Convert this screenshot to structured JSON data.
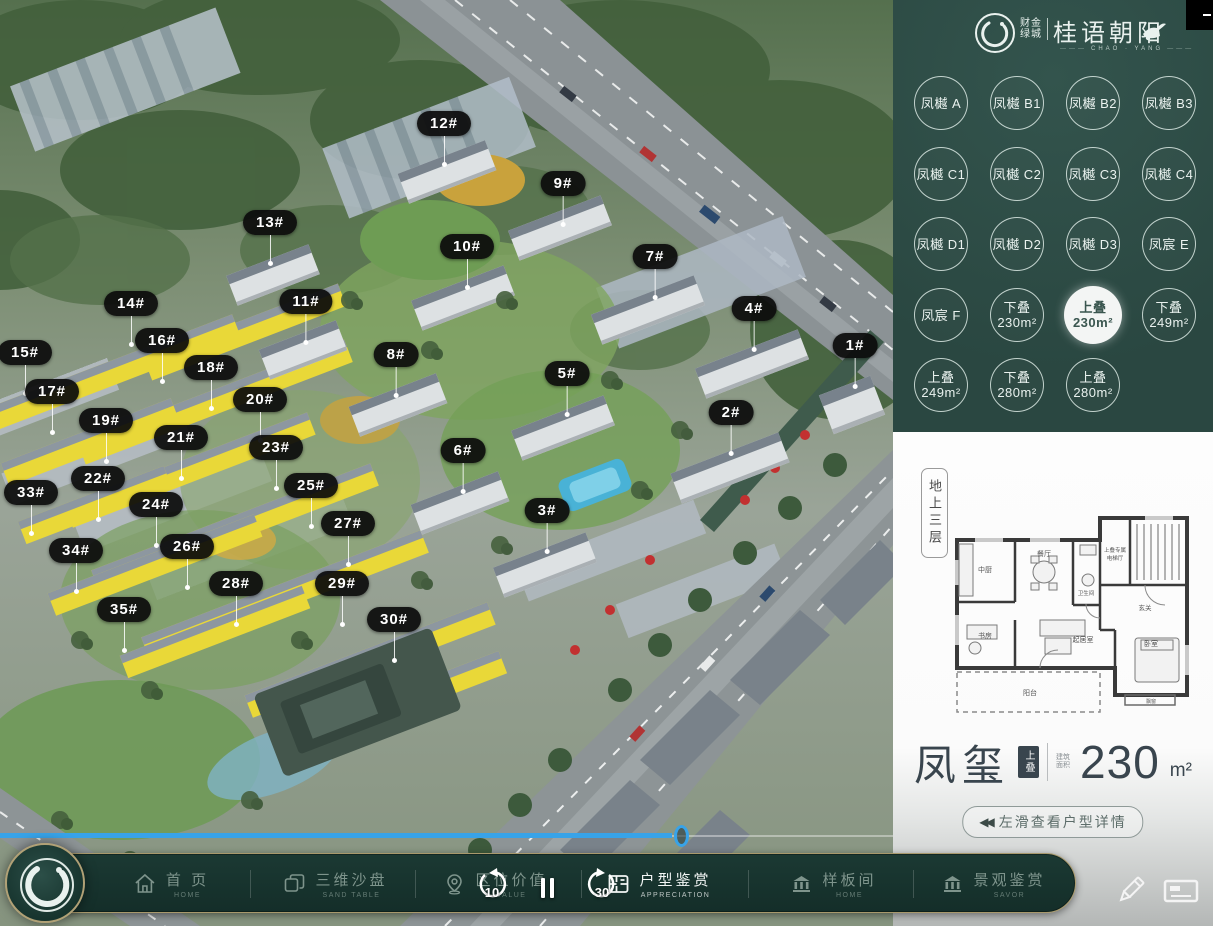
{
  "brand": {
    "pre_line1": "财金",
    "pre_line2": "绿城",
    "name": "桂语朝阳",
    "sub": "CHAO · YANG"
  },
  "unit_selector": {
    "buttons": [
      {
        "label": "凤樾 A"
      },
      {
        "label": "凤樾 B1"
      },
      {
        "label": "凤樾 B2"
      },
      {
        "label": "凤樾 B3"
      },
      {
        "label": "凤樾 C1"
      },
      {
        "label": "凤樾 C2"
      },
      {
        "label": "凤樾 C3"
      },
      {
        "label": "凤樾 C4"
      },
      {
        "label": "凤樾 D1"
      },
      {
        "label": "凤樾 D2"
      },
      {
        "label": "凤樾 D3"
      },
      {
        "label": "凤宸 E"
      },
      {
        "label": "凤宸 F"
      },
      {
        "line1": "下叠",
        "line2": "230m²"
      },
      {
        "line1": "上叠",
        "line2": "230m²",
        "selected": true
      },
      {
        "line1": "下叠",
        "line2": "249m²"
      },
      {
        "line1": "上叠",
        "line2": "249m²"
      },
      {
        "line1": "下叠",
        "line2": "280m²"
      },
      {
        "line1": "上叠",
        "line2": "280m²"
      }
    ]
  },
  "floorplan": {
    "floor_tag": "地上三层",
    "name": "凤玺",
    "name_tag": "上叠",
    "area_prefix": "建筑面积",
    "area": "230",
    "area_unit": "m²",
    "slide_hint": "左滑查看户型详情",
    "slide_icon": "◀◀",
    "rooms": [
      {
        "t": "中厨",
        "x": 40,
        "y": 82,
        "s": 7
      },
      {
        "t": "餐厅",
        "x": 99,
        "y": 66,
        "s": 7
      },
      {
        "t": "卫生间",
        "x": 141,
        "y": 105,
        "s": 5.5
      },
      {
        "t": "上叠专属",
        "x": 170,
        "y": 62,
        "s": 5.5
      },
      {
        "t": "电梯厅",
        "x": 170,
        "y": 70,
        "s": 5.5
      },
      {
        "t": "玄关",
        "x": 200,
        "y": 120,
        "s": 6.5
      },
      {
        "t": "书房",
        "x": 40,
        "y": 148,
        "s": 7
      },
      {
        "t": "起居室",
        "x": 138,
        "y": 152,
        "s": 7
      },
      {
        "t": "卧室",
        "x": 206,
        "y": 156,
        "s": 7
      },
      {
        "t": "阳台",
        "x": 85,
        "y": 205,
        "s": 7
      },
      {
        "t": "飘窗",
        "x": 206,
        "y": 213,
        "s": 5
      }
    ]
  },
  "map": {
    "labels": [
      {
        "text": "1#",
        "x": 855,
        "y": 356
      },
      {
        "text": "2#",
        "x": 731,
        "y": 423
      },
      {
        "text": "3#",
        "x": 547,
        "y": 521
      },
      {
        "text": "4#",
        "x": 754,
        "y": 319
      },
      {
        "text": "5#",
        "x": 567,
        "y": 384
      },
      {
        "text": "6#",
        "x": 463,
        "y": 461
      },
      {
        "text": "7#",
        "x": 655,
        "y": 267
      },
      {
        "text": "8#",
        "x": 396,
        "y": 365
      },
      {
        "text": "9#",
        "x": 563,
        "y": 194
      },
      {
        "text": "10#",
        "x": 467,
        "y": 257
      },
      {
        "text": "11#",
        "x": 306,
        "y": 312
      },
      {
        "text": "12#",
        "x": 444,
        "y": 134
      },
      {
        "text": "13#",
        "x": 270,
        "y": 233
      },
      {
        "text": "14#",
        "x": 131,
        "y": 314
      },
      {
        "text": "15#",
        "x": 25,
        "y": 363
      },
      {
        "text": "16#",
        "x": 162,
        "y": 351
      },
      {
        "text": "17#",
        "x": 52,
        "y": 402
      },
      {
        "text": "18#",
        "x": 211,
        "y": 378
      },
      {
        "text": "19#",
        "x": 106,
        "y": 431
      },
      {
        "text": "20#",
        "x": 260,
        "y": 410
      },
      {
        "text": "21#",
        "x": 181,
        "y": 448
      },
      {
        "text": "22#",
        "x": 98,
        "y": 489
      },
      {
        "text": "23#",
        "x": 276,
        "y": 458
      },
      {
        "text": "24#",
        "x": 156,
        "y": 515
      },
      {
        "text": "25#",
        "x": 311,
        "y": 496
      },
      {
        "text": "26#",
        "x": 187,
        "y": 557
      },
      {
        "text": "27#",
        "x": 348,
        "y": 534
      },
      {
        "text": "28#",
        "x": 236,
        "y": 594
      },
      {
        "text": "29#",
        "x": 342,
        "y": 594
      },
      {
        "text": "30#",
        "x": 394,
        "y": 630
      },
      {
        "text": "33#",
        "x": 31,
        "y": 503
      },
      {
        "text": "34#",
        "x": 76,
        "y": 561
      },
      {
        "text": "35#",
        "x": 124,
        "y": 620
      }
    ],
    "seek_progress_px": 672
  },
  "player": {
    "rewind_label": "10",
    "forward_label": "30"
  },
  "nav": {
    "items": [
      {
        "title": "首 页",
        "sub": "HOME",
        "icon": "home-icon",
        "x": 170
      },
      {
        "title": "三维沙盘",
        "sub": "SAND TABLE",
        "icon": "sand-table-icon",
        "x": 334
      },
      {
        "title": "区位价值",
        "sub": "VALUE",
        "icon": "location-icon",
        "x": 494
      },
      {
        "title": "户型鉴赏",
        "sub": "APPRECIATION",
        "icon": "floorplan-icon",
        "x": 658,
        "active": true
      },
      {
        "title": "样板间",
        "sub": "HOME",
        "icon": "showroom-icon",
        "x": 832
      },
      {
        "title": "景观鉴赏",
        "sub": "SAVOR",
        "icon": "landscape-icon",
        "x": 992
      }
    ],
    "divider_x": [
      249,
      414,
      580,
      747,
      912
    ]
  }
}
